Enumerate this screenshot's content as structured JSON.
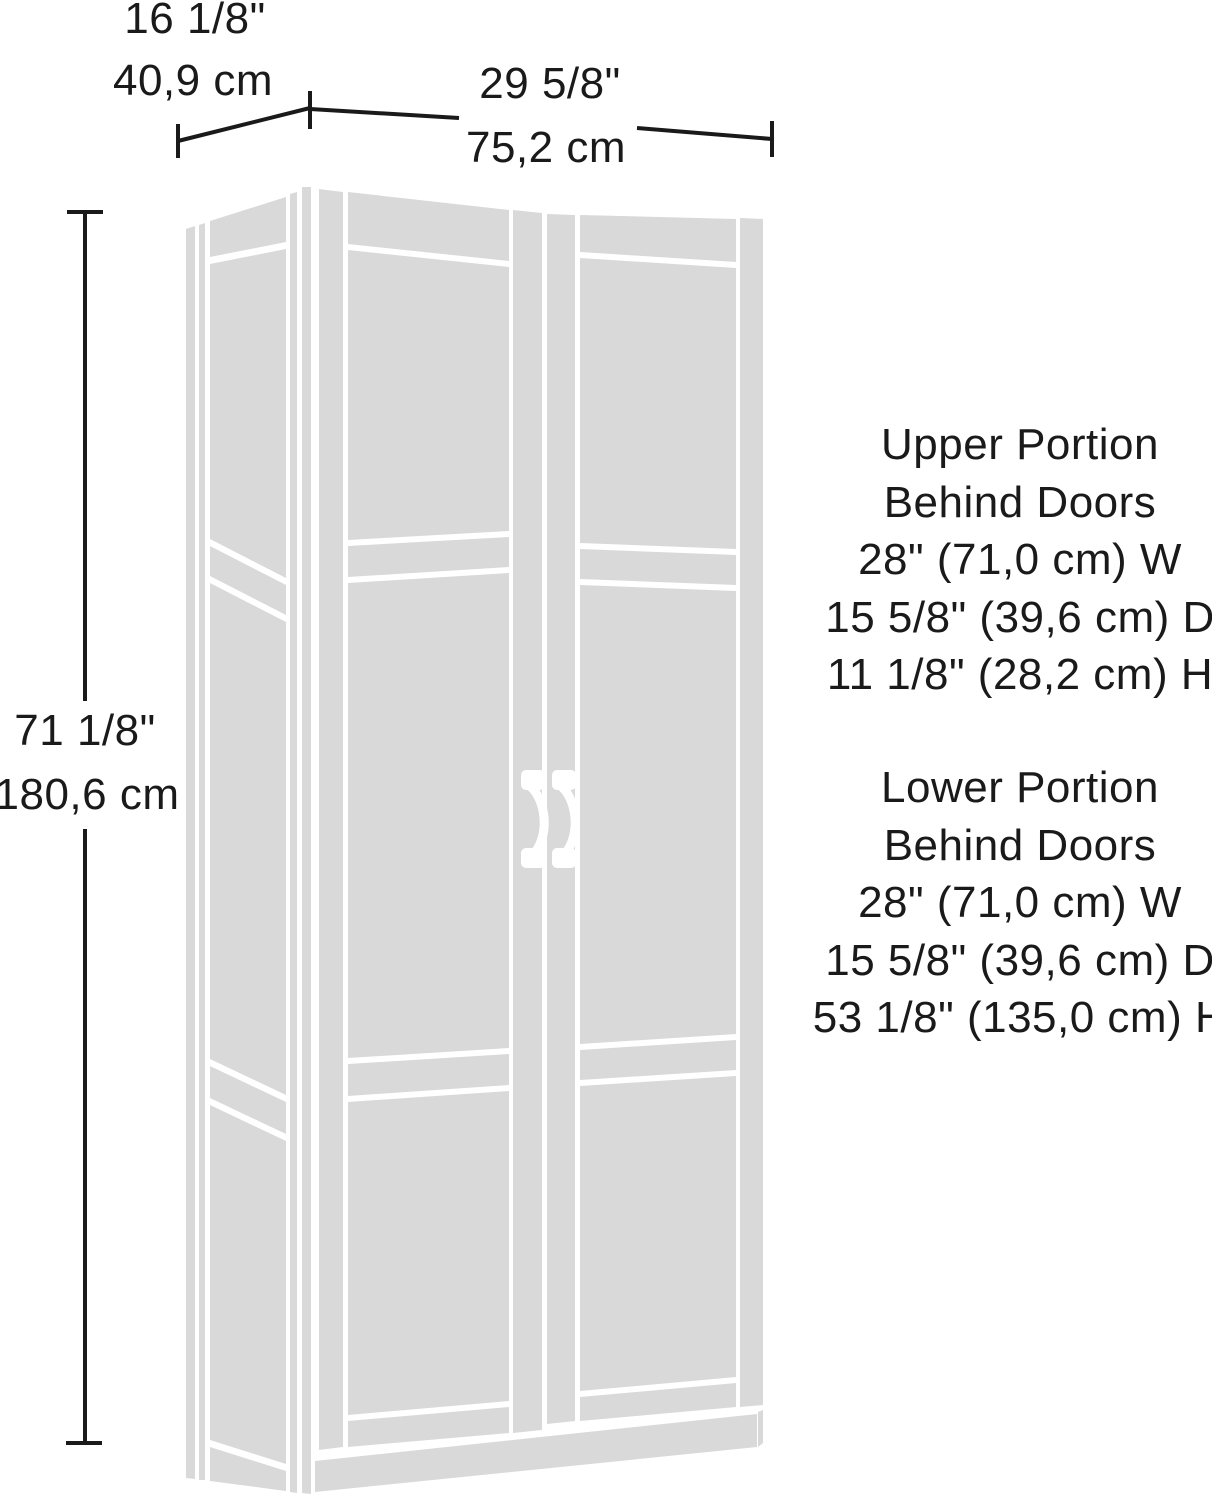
{
  "colors": {
    "cabinet_fill": "#d9d9d9",
    "line": "#1a1a1a",
    "background": "#ffffff"
  },
  "dimensions": {
    "depth": {
      "inches": "16 1/8\"",
      "metric": "40,9 cm"
    },
    "width": {
      "inches": "29 5/8\"",
      "metric": "75,2 cm"
    },
    "height": {
      "inches": "71 1/8\"",
      "metric": "180,6 cm"
    }
  },
  "annotations": {
    "upper": {
      "lines": [
        "Upper Portion",
        "Behind Doors",
        "28\" (71,0 cm) W",
        "15 5/8\" (39,6 cm) D",
        "11 1/8\" (28,2 cm) H"
      ]
    },
    "lower": {
      "lines": [
        "Lower Portion",
        "Behind Doors",
        "28\" (71,0 cm) W",
        "15 5/8\" (39,6 cm) D",
        "53 1/8\" (135,0 cm) H"
      ]
    }
  }
}
